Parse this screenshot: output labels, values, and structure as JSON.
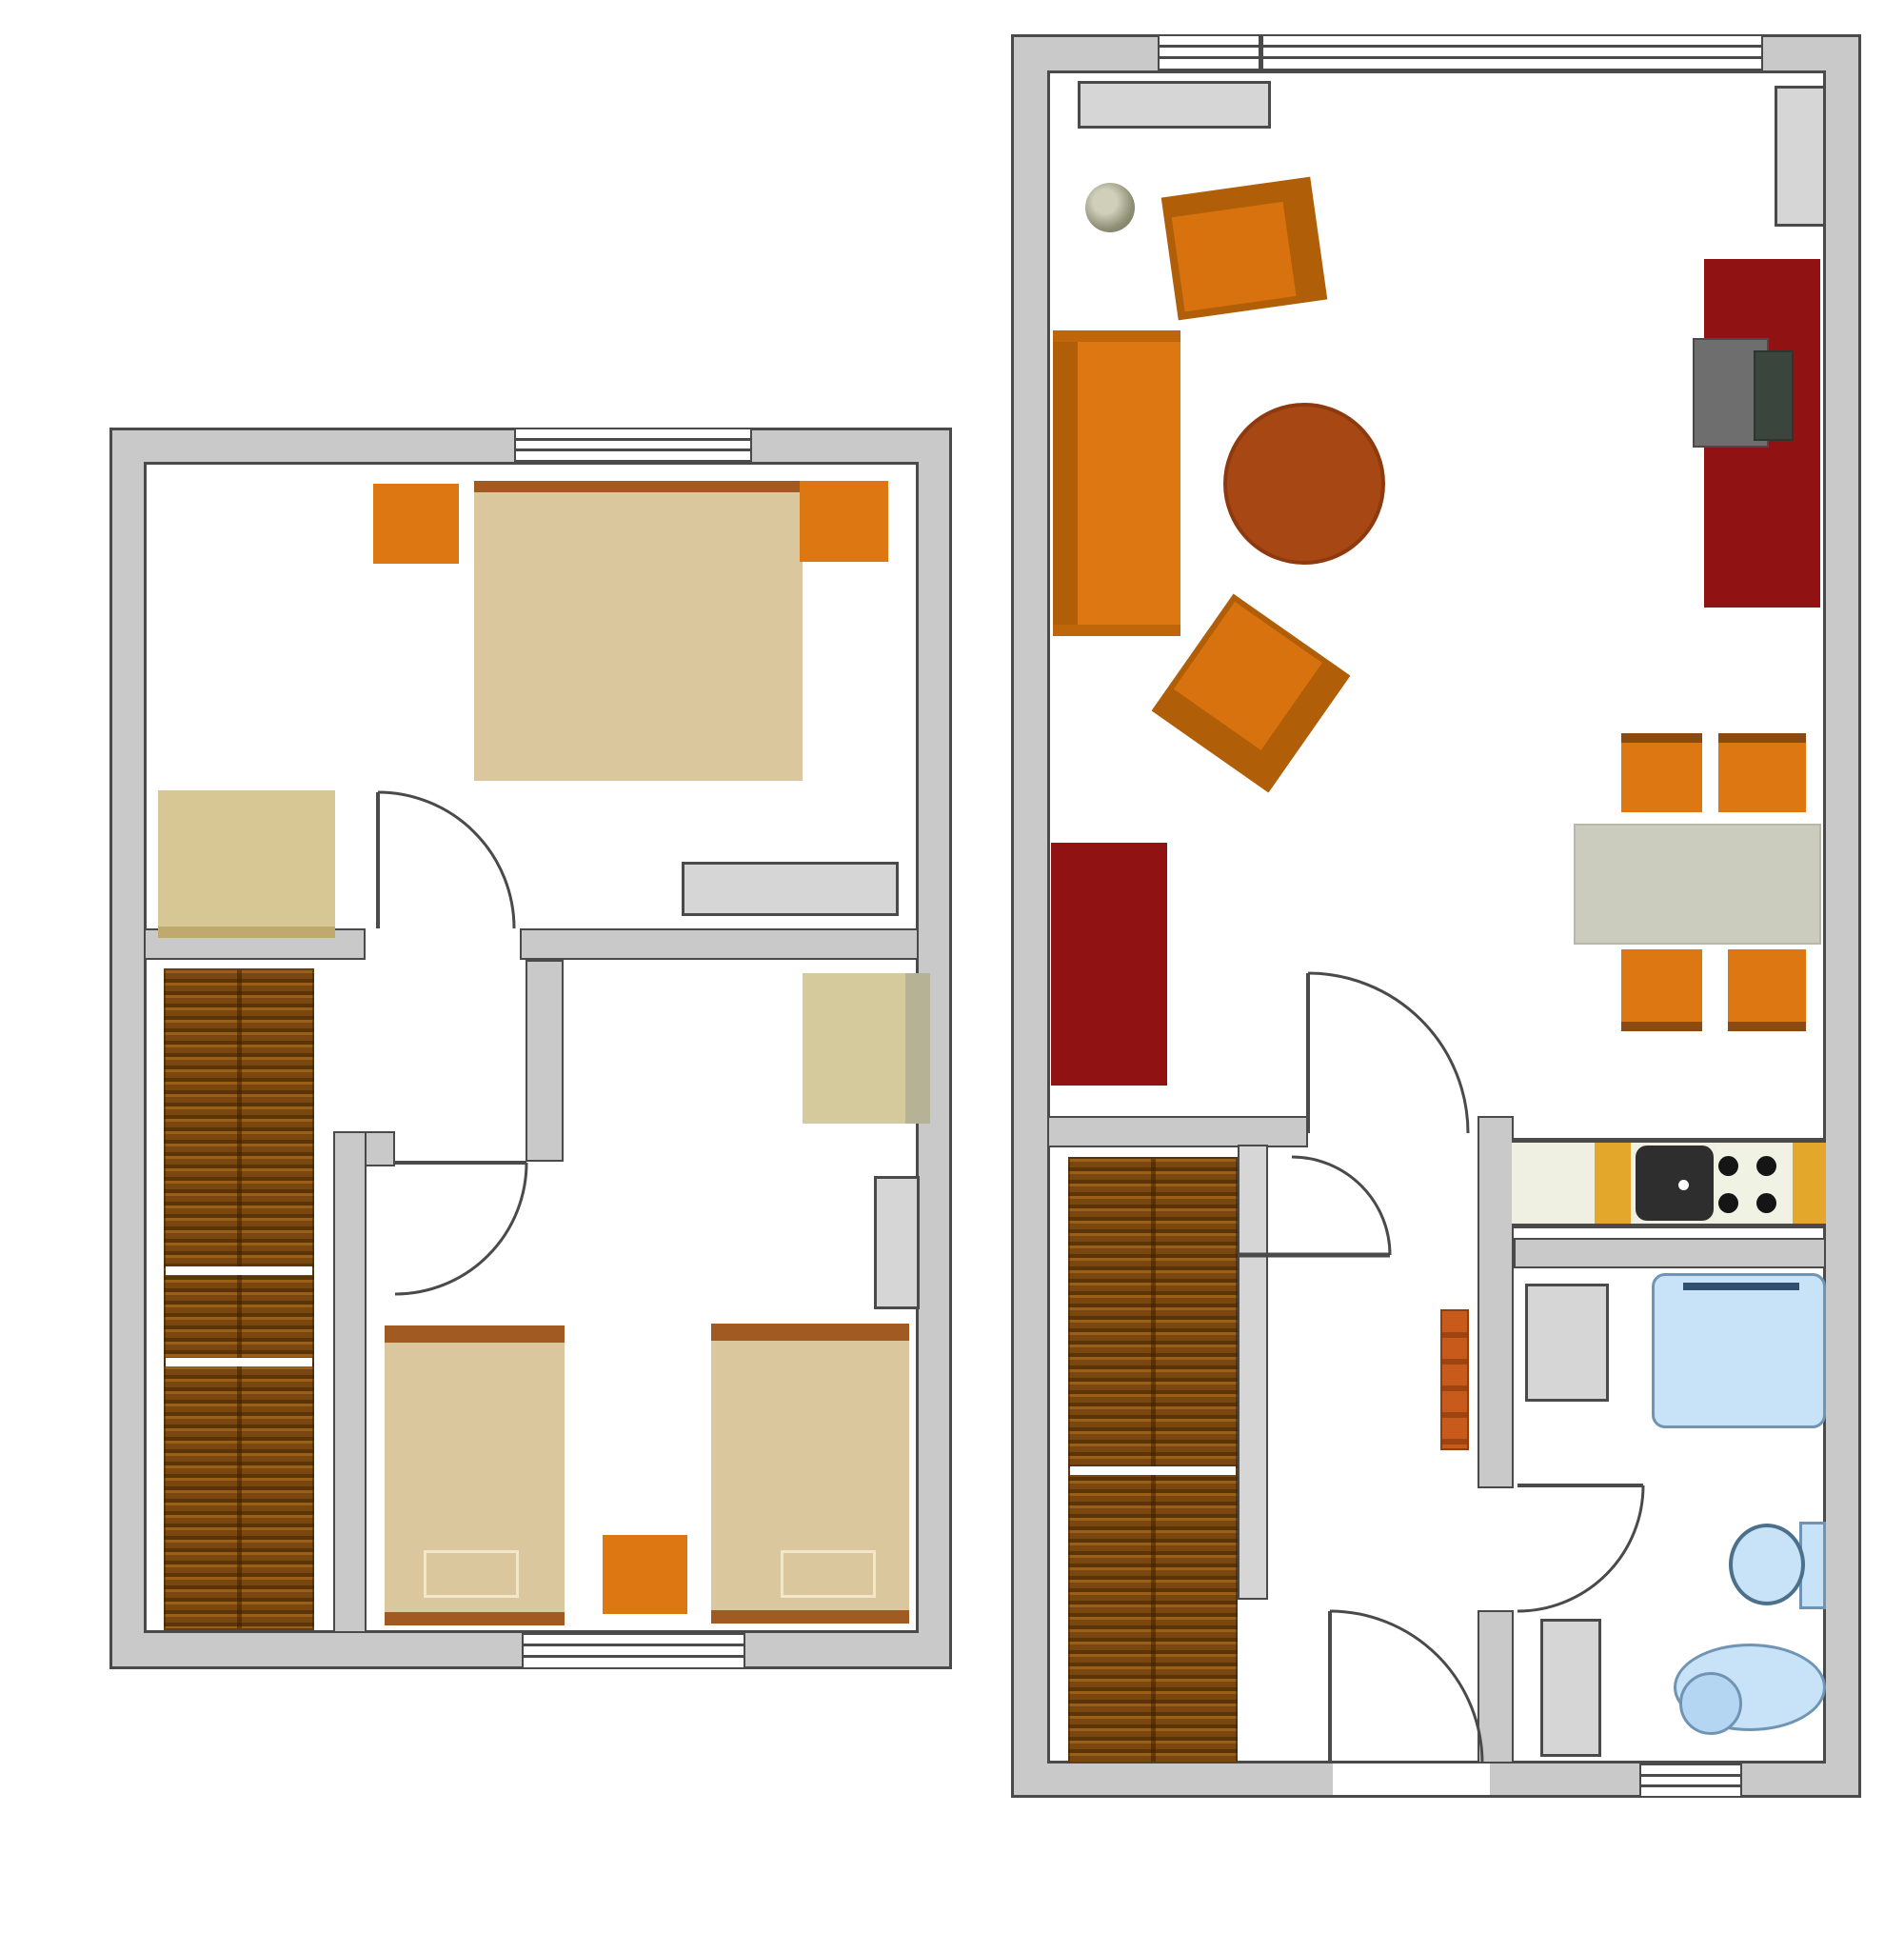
{
  "document": {
    "kind": "floor-plan-drawing",
    "visible_text": [],
    "plans": [
      {
        "name": "upper-floor-plan",
        "rooms": [
          "bedroom-double",
          "stair-hall",
          "children-bedroom"
        ],
        "furniture": [
          "double-bed",
          "nightstand",
          "nightstand",
          "desk",
          "dresser",
          "staircase",
          "kids-table",
          "radiator",
          "single-bed",
          "single-bed",
          "nightstand"
        ],
        "windows": 2,
        "doors": 2
      },
      {
        "name": "ground-floor-plan",
        "rooms": [
          "living-dining-kitchen",
          "stair-hallway",
          "bathroom"
        ],
        "furniture": [
          "sideboard",
          "plant",
          "armchair",
          "sofa",
          "coffee-table",
          "armchair",
          "tv-cabinet",
          "desk",
          "office-chair",
          "radiator",
          "dining-table",
          "dining-chair",
          "dining-chair",
          "dining-chair",
          "dining-chair",
          "kitchen-counter",
          "sink",
          "stove",
          "staircase",
          "banister",
          "radiator",
          "washing-machine",
          "bathtub",
          "toilet",
          "bidet",
          "radiator"
        ],
        "windows": 2,
        "doors": 4
      }
    ]
  },
  "palette": {
    "wall_fill": "#C9C9C9",
    "wall_line": "#4A4A4A",
    "floor": "#FFFFFF",
    "orange": "#DD7712",
    "orange_dark": "#B05E08",
    "orange_seat": "#D8720E",
    "tan": "#DBC79E",
    "bed_strip": "#A05A22",
    "pillow_line": "#F2E7C8",
    "beige": "#D6C795",
    "beige_dark": "#C0A96C",
    "table_beige": "#D5CA9B",
    "table_shade": "#B5B296",
    "gray_item": "#D6D6D6",
    "gray_border": "#4A4A4A",
    "red": "#911212",
    "stair_light": "#9A6018",
    "stair_mid": "#7A4710",
    "stair_dark": "#5C3506",
    "gold": "#E3A82B",
    "counter": "#EFEFE2",
    "stove_bg": "#F0F2E4",
    "sink": "#2E2E2E",
    "blue": "#C8E2F8",
    "blue_border": "#6F94B4",
    "blue_dark": "#2F4F6F",
    "chair_seat": "#6E6E6E",
    "chair_back": "#3A463D",
    "coffee": "#A74814",
    "table_gray": "#CBCCBD",
    "plant": "#8D8D74",
    "radiator_orange": "#C85A1C"
  }
}
